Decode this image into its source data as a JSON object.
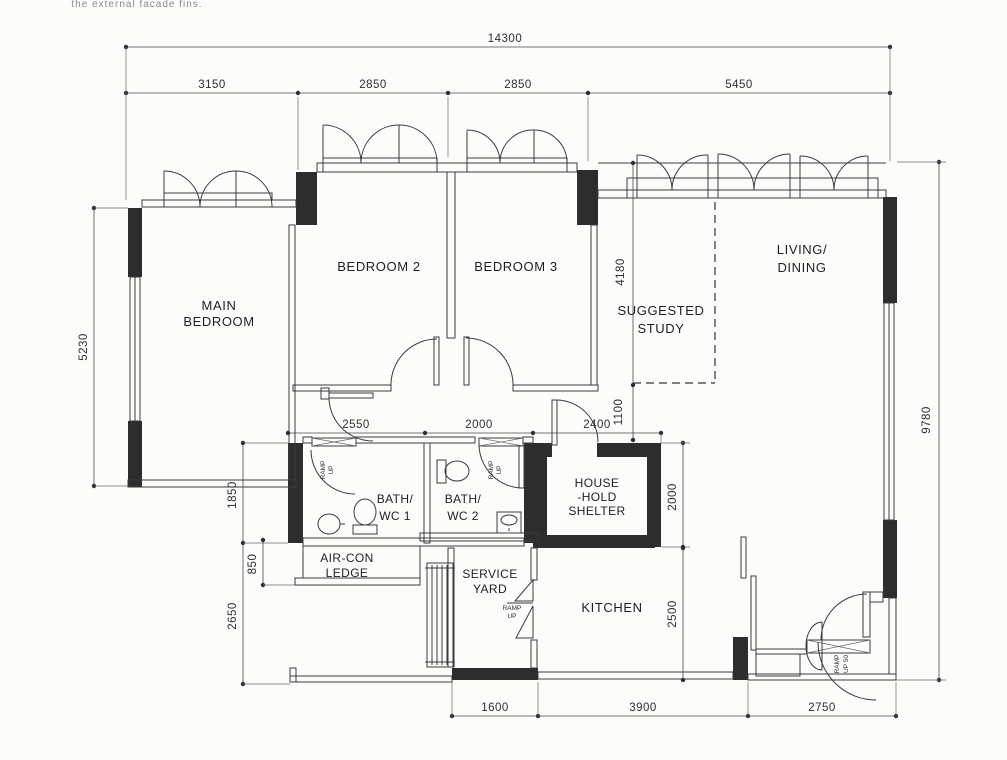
{
  "note": {
    "text": "the external facade fins."
  },
  "rooms": {
    "main_bedroom": {
      "line1": "MAIN",
      "line2": "BEDROOM"
    },
    "bedroom2": {
      "label": "BEDROOM 2"
    },
    "bedroom3": {
      "label": "BEDROOM 3"
    },
    "suggested_study": {
      "line1": "SUGGESTED",
      "line2": "STUDY"
    },
    "living_dining": {
      "line1": "LIVING/",
      "line2": "DINING"
    },
    "bath_wc_1": {
      "line1": "BATH/",
      "line2": "WC 1"
    },
    "bath_wc_2": {
      "line1": "BATH/",
      "line2": "WC 2"
    },
    "household_shelter": {
      "line1": "HOUSE",
      "line2": "-HOLD",
      "line3": "SHELTER"
    },
    "aircon_ledge": {
      "line1": "AIR-CON",
      "line2": "LEDGE"
    },
    "service_yard": {
      "line1": "SERVICE",
      "line2": "YARD"
    },
    "kitchen": {
      "label": "KITCHEN"
    }
  },
  "annotations": {
    "ramp": "RAMP",
    "up": "UP",
    "up50": "UP 50"
  },
  "dimensions": {
    "overall_width": "14300",
    "top_segments": [
      "3150",
      "2850",
      "2850",
      "5450"
    ],
    "left_height": "5230",
    "right_height": "9780",
    "study_depth": "4180",
    "study_gap": "1100",
    "bath1_width": "2550",
    "bath2_width": "2000",
    "shelter_width": "2400",
    "shelter_depth": "2000",
    "bath_depth": "1850",
    "ledge_depth": "850",
    "lower_left_depth": "2650",
    "kitchen_depth": "2500",
    "bottom_segments": [
      "1600",
      "3900",
      "2750"
    ]
  },
  "colors": {
    "wall_fill": "#2d2d2d",
    "line": "#3b3b3b",
    "paper": "#fcfcfa"
  }
}
